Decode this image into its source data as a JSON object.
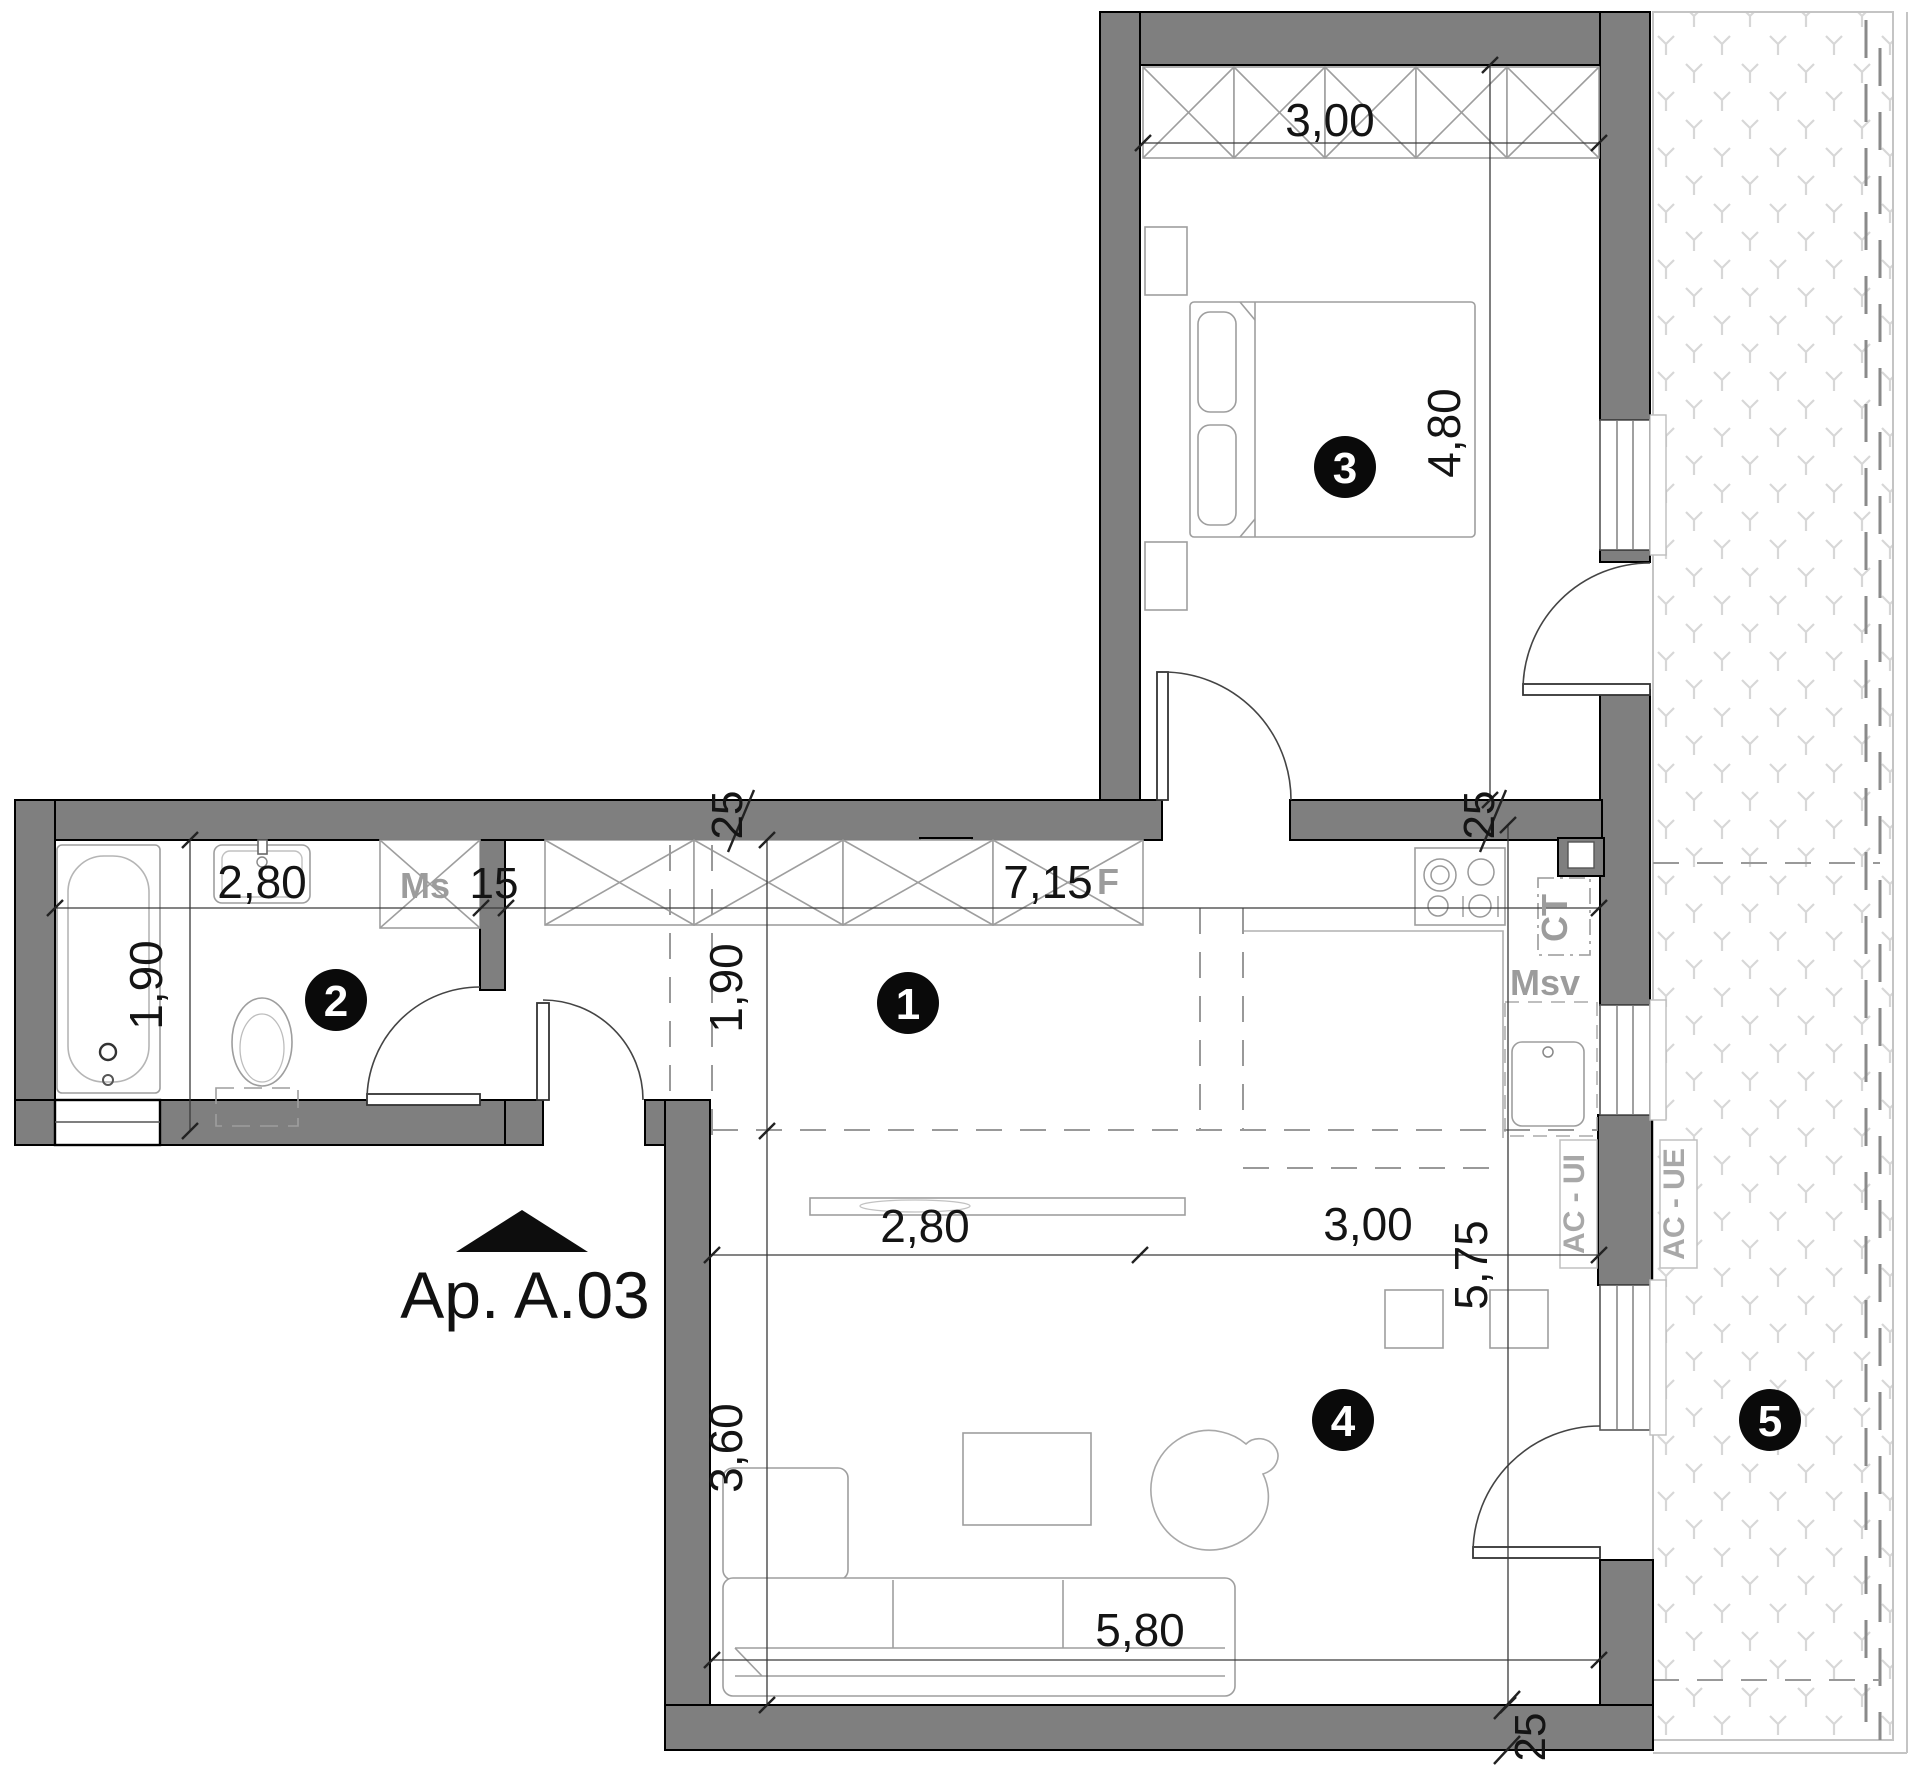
{
  "title": {
    "apartment_label": "Ap. A.03"
  },
  "rooms": [
    {
      "number": "1"
    },
    {
      "number": "2"
    },
    {
      "number": "3"
    },
    {
      "number": "4"
    },
    {
      "number": "5"
    }
  ],
  "dimensions": {
    "bedroom_width": "3,00",
    "bedroom_length": "4,80",
    "bath_width": "2,80",
    "bath_depth": "1,90",
    "partition_thickness": "15",
    "hall_length": "7,15",
    "hall_width": "1,90",
    "wall_top_thickness": "25",
    "wall_right_thickness": "25",
    "wall_bottom_thickness": "25",
    "living_tv_width": "2,80",
    "living_dining_width": "3,00",
    "living_depth": "5,75",
    "living_left_depth": "3,60",
    "living_width": "5,80"
  },
  "labels": {
    "ms": "Ms",
    "fridge": "F",
    "ct": "CT",
    "msv": "Msv",
    "ac_indoor": "AC - UI",
    "ac_outdoor": "AC - UE"
  },
  "colors": {
    "wall": "#7f7f7f",
    "dim_text": "#141414",
    "gray_label": "#9c9c9c",
    "hatch": "#d7d7d7",
    "badge": "#0a0a0a"
  }
}
